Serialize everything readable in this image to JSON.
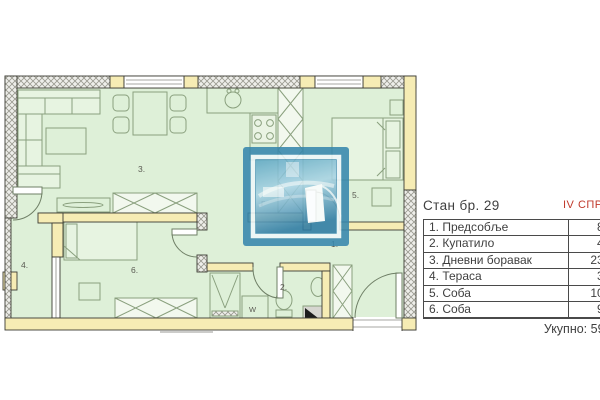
{
  "plan": {
    "labels": {
      "hall": "1.",
      "bath": "2.",
      "living": "3.",
      "terrace": "4.",
      "bedroom_right": "5.",
      "bedroom_bottom": "6.",
      "washer": "W",
      "plan_mark": "Г"
    },
    "colors": {
      "room_fill": "#def0d8",
      "wall_fill": "#f6ecb4",
      "hatch_line": "#99998f",
      "furniture_line": "#8aa07e",
      "watermark_blue": "#3787ad"
    }
  },
  "panel": {
    "title": "Стан бр. 29",
    "floor": "IV СПРАТ",
    "rows": [
      {
        "label": "1. Предсобље",
        "value": "8,"
      },
      {
        "label": "2. Купатило",
        "value": "4,"
      },
      {
        "label": "3. Дневни боравак",
        "value": "23,"
      },
      {
        "label": "4. Тераса",
        "value": "3,"
      },
      {
        "label": "5. Соба",
        "value": "10,"
      },
      {
        "label": "6. Соба",
        "value": "9,"
      }
    ],
    "total": "Укупно: 59,"
  }
}
